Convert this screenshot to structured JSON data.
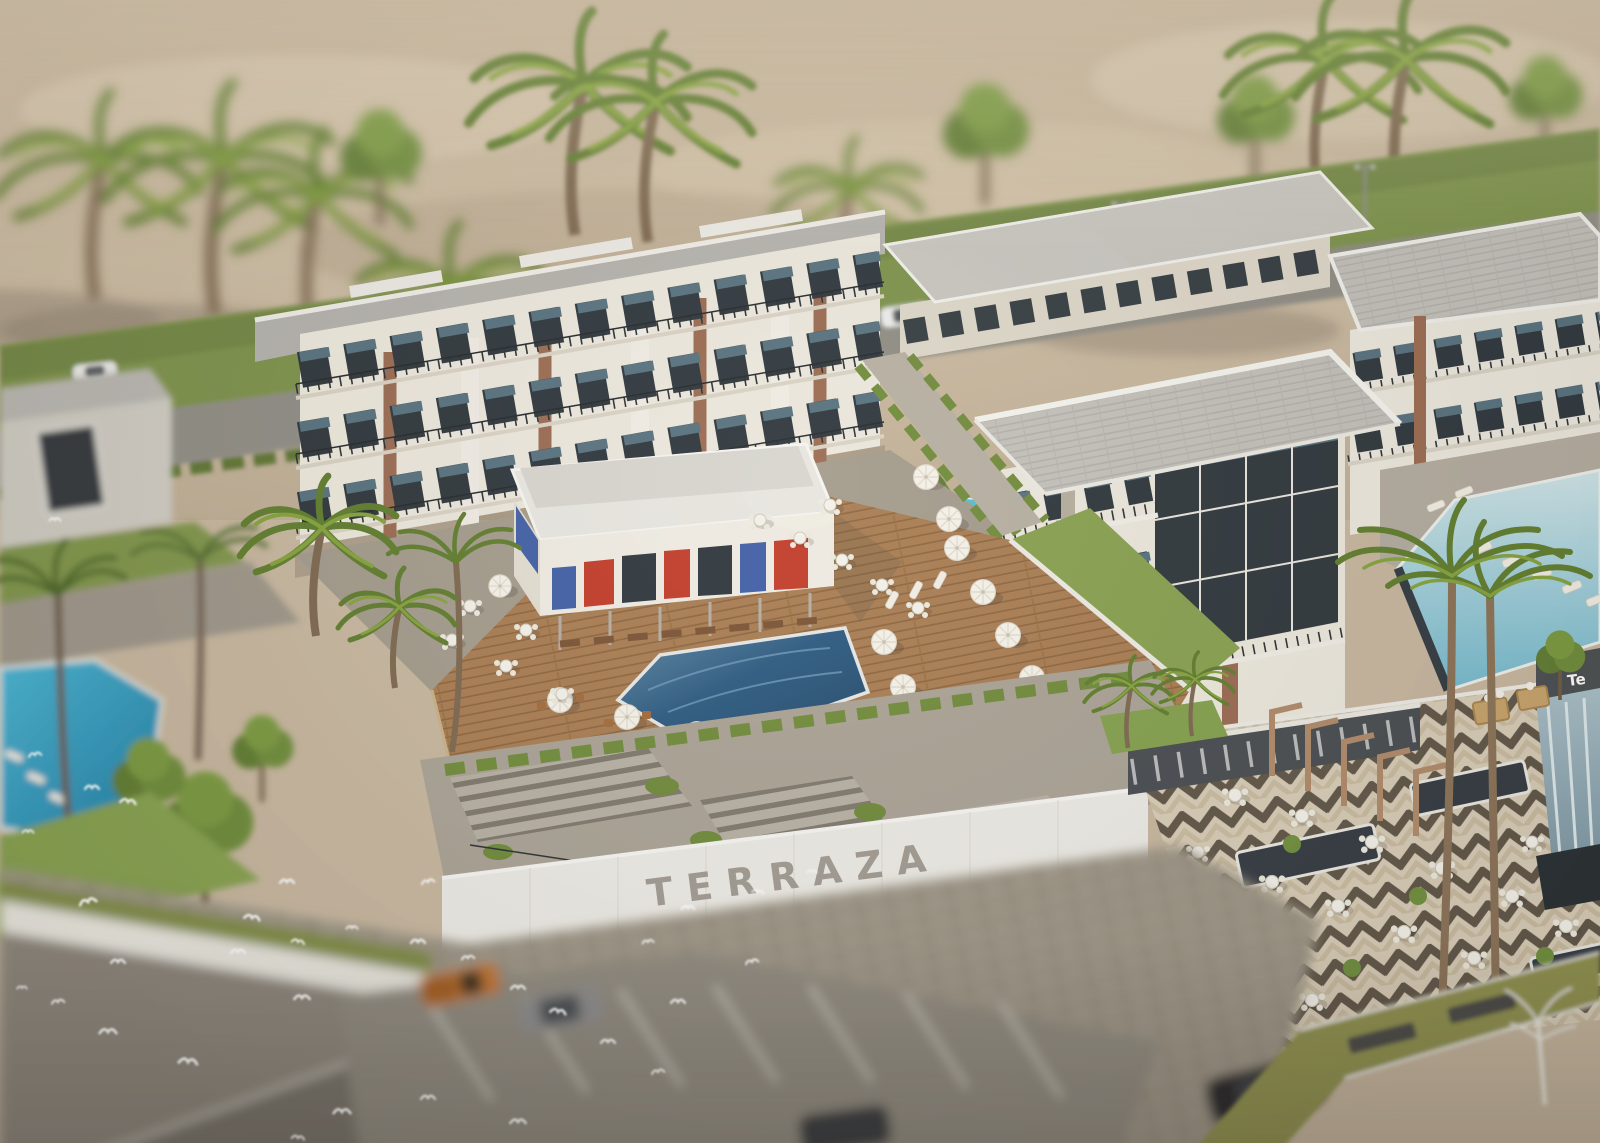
{
  "meta": {
    "render_type": "3D architectural visualization",
    "view": "aerial tilt-shift",
    "project_name": "TERRAZA"
  },
  "signage": {
    "wall_text": "TERRAZA",
    "edge_sign_text": "Te"
  },
  "scene": {
    "description": "Aerial tilt-shift architectural rendering of the TERRAZA resort apartment compound on a desert edge: white multi-storey apartment buildings with balconies and private plunge pools surround a central timber pool deck with a red-and-blue accented clubhouse pavilion, a blue swimming pool lined with white parasols, a chevron-paved dining terrace, grand landscaped stairs above an entrance wall lettered TERRAZA, palm trees throughout, a blurred foreground parking lot with cars, and a flock of white birds flying over.",
    "setting": {
      "backdrop": "desert sand with palms",
      "mid": "lawn verge and access road",
      "foreground": "cobbled plaza and parking lot"
    },
    "landmarks": [
      {
        "id": "desert-backdrop",
        "label": "Desert sand backdrop with palm trees"
      },
      {
        "id": "access-road",
        "label": "Access road with roadside parking"
      },
      {
        "id": "left-apartment-cluster",
        "label": "West apartment buildings"
      },
      {
        "id": "right-apartment-cluster",
        "label": "East apartment buildings with corner glass tower"
      },
      {
        "id": "clubhouse",
        "label": "Pool-bar clubhouse with red and blue panels"
      },
      {
        "id": "main-pool",
        "label": "Central swimming pool"
      },
      {
        "id": "pool-deck",
        "label": "Timber pool deck with parasols and tables"
      },
      {
        "id": "plunge-pools",
        "label": "Private ground-floor plunge pools"
      },
      {
        "id": "grand-stairs",
        "label": "Terraced garden staircase"
      },
      {
        "id": "terraza-wall",
        "label": "Entrance retaining wall with TERRAZA lettering"
      },
      {
        "id": "dining-terrace",
        "label": "Chevron-paved dining terrace"
      },
      {
        "id": "pergola",
        "label": "Timber pergola walk"
      },
      {
        "id": "side-pool",
        "label": "East pool with sun loungers and waterfall wall"
      },
      {
        "id": "community-pool",
        "label": "West community pool in blurred foreground"
      },
      {
        "id": "parking-lot",
        "label": "Parking lot with pickup truck and cars"
      },
      {
        "id": "bird-flock",
        "label": "Flock of white birds"
      }
    ],
    "counts": {
      "apartment_blocks": 6,
      "palm_trees": 22,
      "parasols": 15,
      "deck_tables": 11,
      "terrace_tables": 15,
      "plunge_pools": 7,
      "cars": 6,
      "birds": 34
    }
  },
  "palette": {
    "desert_sand": "#c7b7a0",
    "lawn_green": "#7d924c",
    "hedge_green": "#6f8b3b",
    "roof_grey": "#b4b2ae",
    "facade_white": "#ece8de",
    "stone_beige": "#ded8cb",
    "wood_accent": "#9a6a52",
    "glazing_dark": "#2d363d",
    "glazing_reflection": "#56717f",
    "clubhouse_red": "#c23b2a",
    "clubhouse_blue": "#3f5fa8",
    "main_pool_blue": "#2b5a82",
    "side_pool_cyan": "#49b7d6",
    "plunge_pool_cyan": "#4fc0d8",
    "deck_timber": "#a87c52",
    "paving_grey": "#a39b8d",
    "terrace_cream": "#d8cdb8",
    "terrace_stripe": "#5f5548",
    "parasol_white": "#f6f3ec",
    "stair_stone": "#b6b0a5",
    "sign_letter_grey": "#a09b93",
    "pickup_orange": "#bf7433",
    "bird_white": "#ffffff",
    "pergola_timber": "#b08a6b"
  }
}
